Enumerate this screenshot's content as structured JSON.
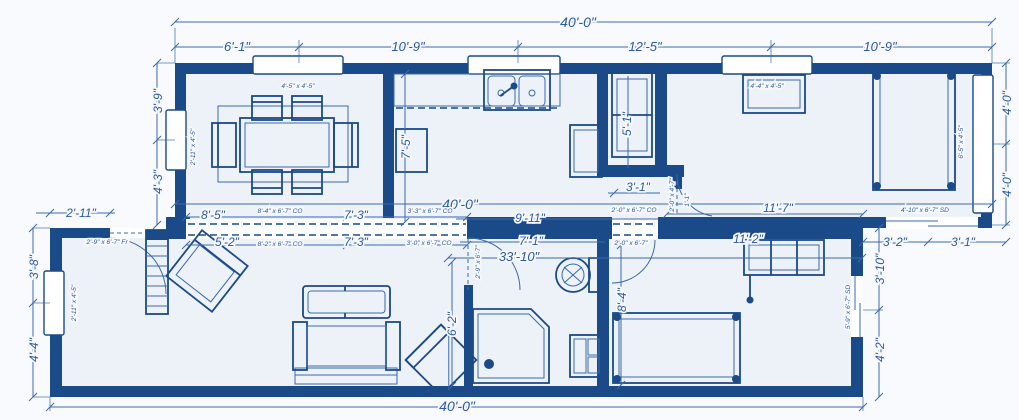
{
  "drawing": {
    "kind": "architectural-floor-plan",
    "units": "feet-inches"
  },
  "colors": {
    "wall": "#1a4a87",
    "line": "#3a69ad",
    "text": "#2a59a4",
    "floor": "#edf1f8",
    "bg": "#f8fafd"
  },
  "dims": {
    "topOverall": "40'-0\"",
    "topSegs": [
      "6'-1\"",
      "10'-9\"",
      "12'-5\"",
      "10'-9\""
    ],
    "leftUpper": [
      "3'-9\"",
      "4'-3\""
    ],
    "rightUpper": [
      "4'-0\"",
      "4'-0\""
    ],
    "midOverall": "40'-0\"",
    "midLeft": "2'-11\"",
    "row1": [
      "8'-5\"",
      "7'-3\"",
      "9'-11\"",
      "11'-7\""
    ],
    "row2": [
      "5'-2\"",
      "7'-3\"",
      "7'-1\"",
      "33'-10\""
    ],
    "bed2Width": "11'-2\"",
    "kitchenDepth": "7'-5\"",
    "closetHeight": "5'-1\"",
    "hall31": "3'-1\"",
    "hall11": "1'-1\"",
    "bathWall": "6'-2\"",
    "bed2Height": "8'-4\"",
    "leftLower": [
      "3'-8\"",
      "4'-4\""
    ],
    "rightLower": [
      "3'-10\"",
      "4'-2\""
    ],
    "bottomRight": [
      "3'-2\"",
      "3'-1\""
    ],
    "bottomOverall": "40'-0\""
  },
  "openings": {
    "winDining": "4'-5\" x 4'-5\"",
    "winBed": "4'-4\" x 4'-5\"",
    "winLeftUpper": "2'-11\" x 4'-5\"",
    "winLeftLower": "2'-11\" x 4'-5\"",
    "winRight": "6'-5\" x 4'-5\"",
    "doorFront": "2'-9\" x 6'-7\" Fr",
    "coRow1a": "8'-4\" x 6'-7\" CO",
    "coRow1b": "3'-3\" x 6'-7\" CO",
    "coRow2a": "8'-2\" x 6'-7\" CO",
    "coRow2b": "3'-0\" x 6'-7\" CO",
    "coHall": "2'-0\" x 6'-7\" CO",
    "doorBed2": "2'-0\" x 6'-7\"",
    "doorBath": "2'-9\" x 6'-7\"",
    "doorHallSmall": "2'-0\" x 4'-7\"",
    "sdBed1": "4'-10\" x 6'-7\" SD",
    "sdBed2": "5'-9\" x 6'-7\" SD"
  }
}
